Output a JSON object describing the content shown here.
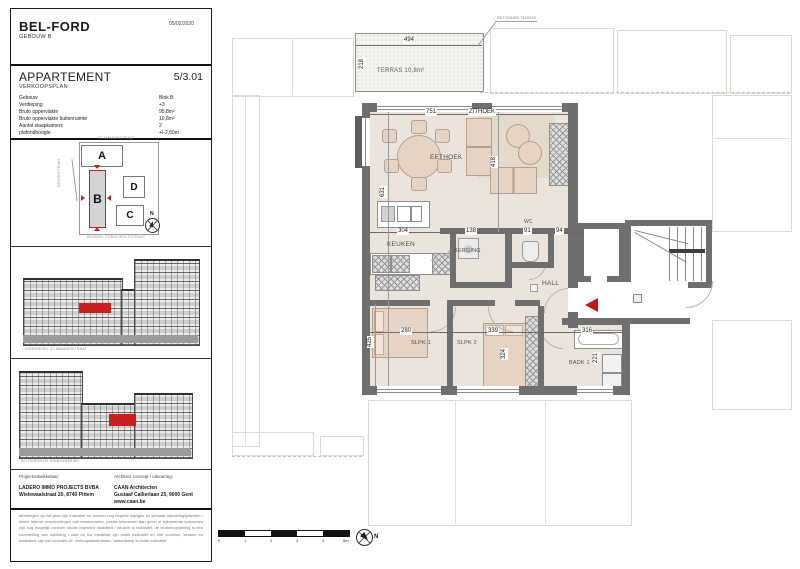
{
  "header": {
    "project": "BEL-FORD",
    "building": "GEBOUW B",
    "date": "05/02/2020"
  },
  "sheet": {
    "title": "APPARTEMENT",
    "number": "5/3.01",
    "subtitle": "VERKOOPSPLAN"
  },
  "info": {
    "rows": [
      {
        "label": "Gebouw",
        "value": "Blok B"
      },
      {
        "label": "Verdieping",
        "value": "+3"
      },
      {
        "label": "Bruto oppervlakte",
        "value": "95,8m²"
      },
      {
        "label": "Bruto oppervlakte buitenruimte",
        "value": "10,8m²"
      },
      {
        "label": "Aantal slaapkamers",
        "value": "2"
      },
      {
        "label": "plafondhoogte",
        "value": "+/-2,50m"
      }
    ]
  },
  "site": {
    "street_top": "ST-AMANDSSTRAAT",
    "street_left": "NOORDSTRAAT",
    "street_bottom": "HENDRIK CONSCIENCESTRAAT",
    "block_a": "A",
    "block_b": "B",
    "block_c": "C",
    "block_d": "D",
    "north": "N"
  },
  "elevations": {
    "front_caption": "VOORGEVEL ST-AMANDSSTRAAT",
    "rear_caption": "ACHTERGEVEL BINNENGEBIED"
  },
  "credits": {
    "developer_heading": "Projectontwikkelaar:",
    "developer_name": "LADERO IMMO PROJECTS BVBA",
    "developer_address": "Wielewaalstraat 20, 8740 Pittem",
    "architect_heading": "Architect concept / uitvoering:",
    "architect_name": "CAAN Architecten",
    "architect_address": "Gustaaf Callierlaan 25, 9000 Gent",
    "architect_site": "www.caan.be"
  },
  "disclaimer": "afmetingen op het plan zijn indicatief en kunnen nog beperkt wijzigen bij opmaak uitvoeringsplannen / kleine interne verschuivingen van binnenmuren, positie kolommen aan gevel of bijkomende kolommen zijn nog mogelijk conform studie ingenieur stabiliteit / keuken is indicatief, de keukenopstelling is een voorstelling van inrichting / vast en los meubilair zijn enkel indicatief en niet voorzien, keuken en badkamer zijn wel voorzien cfr. verkoopslastenboek / tuinontwerp is louter indicatief",
  "plan": {
    "note_terras": "BETONNEN TERRAS",
    "rooms": {
      "terras": "TERRAS 10,8m²",
      "eethoek": "EETHOEK",
      "zithoek": "ZITHOEK",
      "keuken": "KEUKEN",
      "berging": "BERGING",
      "wc": "WC",
      "hall": "HALL",
      "slpk1": "SLPK 1",
      "slpk2": "SLPK 2",
      "badk1": "BADK 1"
    },
    "dims": {
      "terras_w": "494",
      "terras_d": "218",
      "living_w": "751",
      "living_h": "631",
      "zit_d": "418",
      "keuken_w": "304",
      "berging_w": "138",
      "wc_w": "91",
      "gang_w": "94",
      "slpk1_w": "280",
      "slpk1_h": "425",
      "slpk2_w": "339",
      "slpk2_h": "324",
      "badk_w": "316",
      "badk_d": "221"
    }
  },
  "scalebar": {
    "t0": "0",
    "t1": "1",
    "t2": "2",
    "t3": "3",
    "t4": "4",
    "t5": "5m",
    "north": "N"
  },
  "colors": {
    "accent_red": "#c01818",
    "wall_gray": "#6f6f6f",
    "floor_beige": "#ebe4dc"
  }
}
